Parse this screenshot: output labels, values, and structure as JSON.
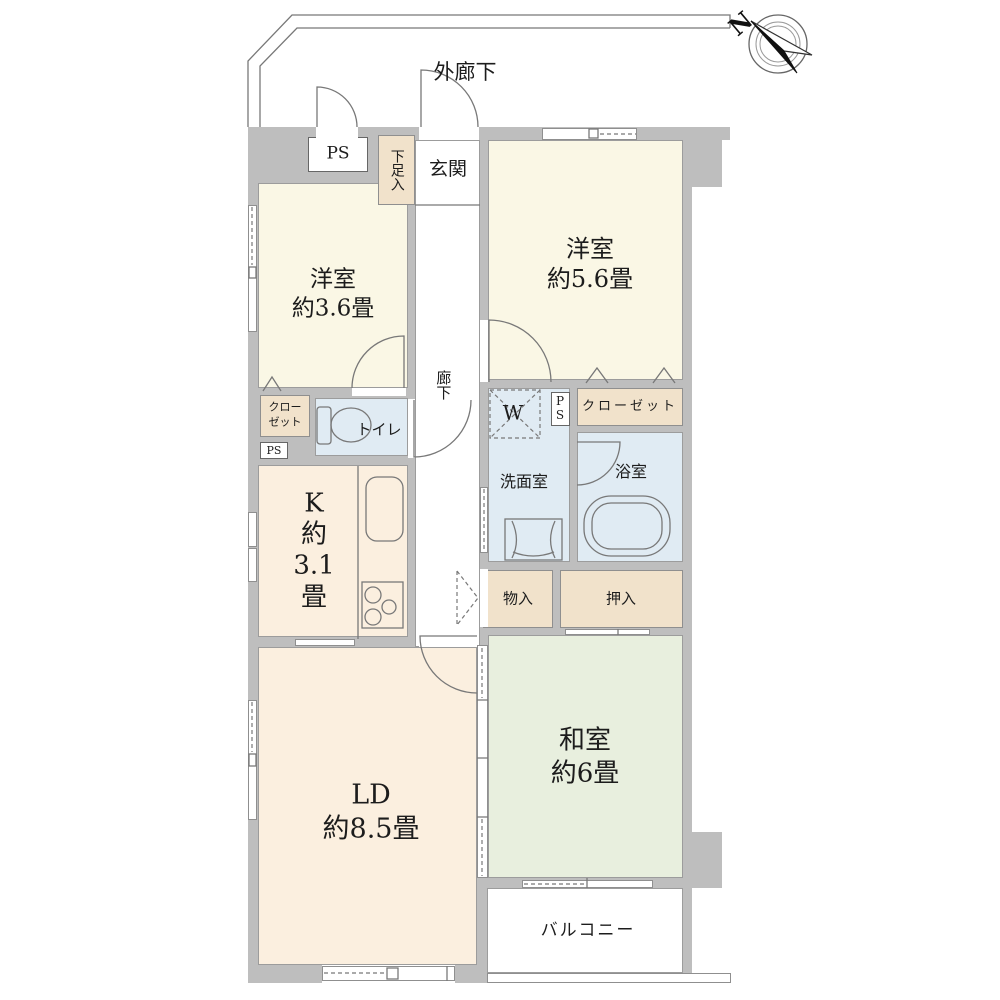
{
  "colors": {
    "wall": "#bebebe",
    "western_room": "#faf7e5",
    "living_kitchen": "#fbefdf",
    "japanese_room": "#e8efde",
    "storage_tan": "#f1e2cb",
    "wet_area_blue": "#e0ebf3",
    "line": "#787878"
  },
  "compass": {
    "north": "N"
  },
  "common": {
    "exterior_corridor": "外廊下",
    "balcony": "バルコニー",
    "corridor": "廊下",
    "entrance": "玄関",
    "shoe_cabinet": "下足入",
    "pipe_space": "PS",
    "pipe_space_vertical": [
      "P",
      "S"
    ]
  },
  "rooms": {
    "western_a": {
      "name": "洋室",
      "size": "約3.6畳"
    },
    "western_b": {
      "name": "洋室",
      "size": "約5.6畳"
    },
    "living_dining": {
      "name": "LD",
      "size": "約8.5畳"
    },
    "kitchen": {
      "lines": [
        "K",
        "約",
        "3.1",
        "畳"
      ]
    },
    "japanese": {
      "name": "和室",
      "size": "約6畳"
    },
    "toilet": "トイレ",
    "washroom": "洗面室",
    "bathroom": "浴室",
    "closet": "クローゼット",
    "closet_two_line": [
      "クロー",
      "ゼット"
    ],
    "storage": "物入",
    "futon_closet": "押入",
    "washer": "W"
  }
}
